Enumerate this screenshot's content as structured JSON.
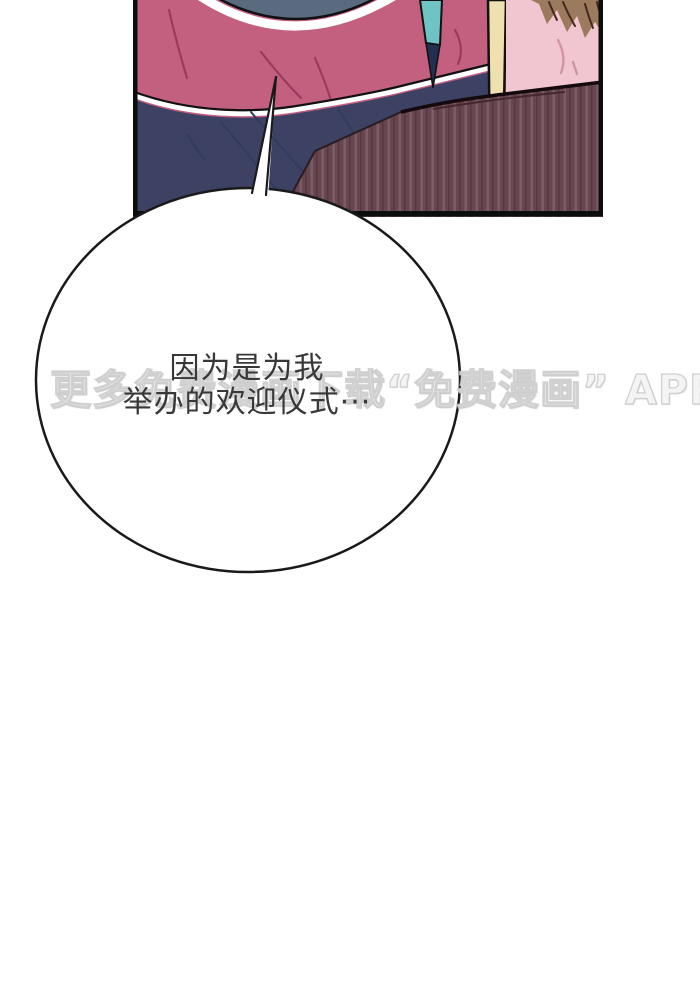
{
  "page": {
    "background_color": "#ffffff"
  },
  "speech_bubble": {
    "line1": "因为是为我",
    "line2": "举办的欢迎仪式···",
    "text_color": "#383838",
    "fill": "#ffffff",
    "outline": "#1a1a1a"
  },
  "watermark": {
    "text": "更多免费漫画下载“免费漫画” APP。"
  },
  "artwork": {
    "colors": {
      "pink_shirt": "#c4607f",
      "pink_fold": "#993a5e",
      "navy_shirt": "#3d4265",
      "navy_fold": "#333a5c",
      "white_stripe": "#ffffff",
      "collar": "#5a6b80",
      "teal_lanyard": "#6fc3c4",
      "lanyard_wedge": "#232f4e",
      "cream_strap": "#eee0af",
      "light_pink_shirt": "#f2c6d0",
      "light_pink_fold": "#cf95a6",
      "hair_brown": "#9c7a5e",
      "hair_dark": "#43281f",
      "sofa_base": "#67464f",
      "sofa_stripe_light": "#7c5d67",
      "sofa_stripe_dark": "#57383f",
      "outline_black": "#111111",
      "panel_border": "#0d0d0d"
    }
  }
}
